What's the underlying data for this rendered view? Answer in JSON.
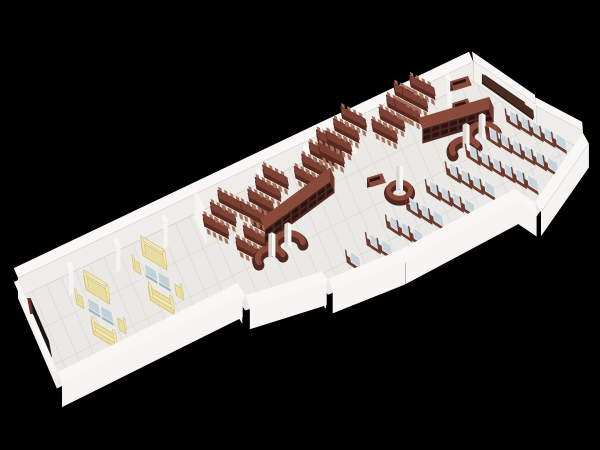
{
  "scene": {
    "description": "3D axonometric cutaway render of a long narrow library / reading room floor plan viewed from above on a black background",
    "background": "#000000",
    "zones": [
      {
        "name": "media-wall",
        "items": [
          {
            "type": "display-panel",
            "count": 1
          }
        ]
      },
      {
        "name": "lounge",
        "items": [
          {
            "type": "sofa",
            "count": 4
          },
          {
            "type": "armchair",
            "count": 4
          },
          {
            "type": "glass-coffee-table",
            "count": 4
          }
        ]
      },
      {
        "name": "reading-tables",
        "items": [
          {
            "type": "long-table-with-chairs",
            "count": 26
          }
        ]
      },
      {
        "name": "book-stacks",
        "items": [
          {
            "type": "double-sided-bookshelf",
            "count": 2
          },
          {
            "type": "small-shelf",
            "count": 3
          },
          {
            "type": "curved-service-desk",
            "count": 2
          },
          {
            "type": "round-kiosk-desk",
            "count": 1
          },
          {
            "type": "column",
            "count": 5
          }
        ]
      },
      {
        "name": "study-carrels",
        "items": [
          {
            "type": "carrel-desk-with-chair",
            "count": 46
          }
        ]
      },
      {
        "name": "presentation-wall",
        "items": [
          {
            "type": "green-board",
            "count": 1
          },
          {
            "type": "media-counter",
            "count": 1
          }
        ]
      }
    ],
    "palette": {
      "bg": "#000000",
      "wallTop": "#f8f7f5",
      "wallFace": "#efede9",
      "wallFaceAlt": "#f3f1ec",
      "wallOuter": "#f5f4f1",
      "floor": "#ebe9e5",
      "grid": "#dcd9d3",
      "woodDark": "#4f2620",
      "wood": "#6e382c",
      "woodTop": "#8a4a3a",
      "shelfSlot": "#2a1410",
      "tableTop": "#7c4134",
      "tableSide": "#57291f",
      "chairNub": "#a4705a",
      "glass": "#c7d3d9",
      "glassEdge": "#eef2f3",
      "deskBase": "#6b3a2d",
      "sofa": "#eadc9e",
      "sofaDark": "#cdbb7a",
      "sofaLight": "#f2e7b4",
      "coffeeGlass": "#c2d1d7",
      "coffeeEdge": "#9fb4bc",
      "board": "#2f5f4b",
      "boardInner": "#3c7259",
      "boardFrame": "#45291d",
      "counterDark": "#301d16",
      "counterTop": "#4a2c20",
      "tvBlack": "#121212",
      "tvFrame": "#6e2b1e",
      "column": "#f7f6f3",
      "columnSide": "#dbd8d3"
    },
    "layout": {
      "proj": {
        "U": [
          4.73,
          -2.35
        ],
        "V": [
          5.0,
          11.6
        ],
        "O": [
          18,
          298
        ]
      },
      "floor": [
        [
          0,
          0
        ],
        [
          95.5,
          0.7
        ],
        [
          103.2,
          6.0
        ],
        [
          109.5,
          9.4
        ],
        [
          96,
          12.6
        ],
        [
          93.5,
          10.9
        ],
        [
          69,
          11.2
        ],
        [
          54.2,
          10.7
        ],
        [
          53.8,
          9.9
        ],
        [
          38.6,
          8.9
        ],
        [
          38.2,
          7.8
        ],
        [
          0,
          7.8
        ]
      ],
      "backWalls": [
        {
          "a": [
            0,
            0
          ],
          "b": [
            95.5,
            0.7
          ],
          "h": 20,
          "out": [
            0,
            -1
          ],
          "face": "wallFace"
        },
        {
          "a": [
            95.5,
            0.7
          ],
          "b": [
            103.2,
            6.0
          ],
          "h": 21,
          "out": [
            0.57,
            -0.82
          ],
          "face": "wallFaceAlt"
        },
        {
          "a": [
            103.2,
            6.0
          ],
          "b": [
            109.5,
            9.4
          ],
          "h": 19,
          "out": [
            0.63,
            -0.77
          ],
          "face": "wallFace"
        },
        {
          "a": [
            0,
            7.8
          ],
          "b": [
            0,
            0
          ],
          "h": 18,
          "out": [
            -1,
            0
          ],
          "face": "wallFaceAlt"
        }
      ],
      "frontWalls": [
        {
          "a": [
            109.5,
            9.4
          ],
          "b": [
            96,
            12.6
          ],
          "h": 17
        },
        {
          "a": [
            96,
            12.6
          ],
          "b": [
            93.5,
            10.9
          ],
          "h": 16
        },
        {
          "a": [
            93.5,
            10.9
          ],
          "b": [
            69,
            11.2
          ],
          "h": 16
        },
        {
          "a": [
            69,
            11.2
          ],
          "b": [
            54.2,
            10.7
          ],
          "h": 16
        },
        {
          "a": [
            54.2,
            10.7
          ],
          "b": [
            53.8,
            9.9
          ],
          "h": 15
        },
        {
          "a": [
            53.8,
            9.9
          ],
          "b": [
            38.6,
            8.9
          ],
          "h": 15
        },
        {
          "a": [
            38.6,
            8.9
          ],
          "b": [
            38.2,
            7.8
          ],
          "h": 15
        },
        {
          "a": [
            38.2,
            7.8
          ],
          "b": [
            0,
            7.8
          ],
          "h": 16
        }
      ],
      "stub": {
        "a": [
          38,
          2.4
        ],
        "b": [
          38,
          0
        ],
        "h": 16
      },
      "pilasters": [
        10,
        20,
        30,
        50,
        60,
        70,
        80,
        90
      ],
      "tv": {
        "x": 1.0,
        "y1": 1.5,
        "y2": 5.2,
        "h": 15
      },
      "board": {
        "t1": 0.18,
        "t2": 0.82,
        "e1": 4,
        "e2": 15
      },
      "counter": {
        "a": [
          96.4,
          1.8
        ],
        "b": [
          102.6,
          6.2
        ],
        "h": 10
      },
      "sofaGroups": [
        [
          13,
          4.2
        ],
        [
          25.5,
          3.8
        ]
      ],
      "sofaRot": 31,
      "tableGroups": [
        [
          39.5,
          2.2,
          3
        ],
        [
          43.5,
          5.0,
          4
        ],
        [
          47.0,
          2.6,
          4
        ],
        [
          59.0,
          2.0,
          4
        ],
        [
          65.0,
          1.2,
          4
        ],
        [
          76.0,
          1.4,
          4
        ],
        [
          81.5,
          0.8,
          3
        ]
      ],
      "tableRot": 28,
      "shelves": [
        [
          47,
          4.9,
          63,
          3.7
        ],
        [
          82,
          3.3,
          96,
          4.3
        ]
      ],
      "smallShelves": [
        [
          92.5,
          1.1,
          3.5
        ],
        [
          91,
          2.7,
          3.0
        ],
        [
          70.5,
          5.0,
          3.0
        ]
      ],
      "sDesks": [
        [
          48.5,
          6.3
        ],
        [
          90.5,
          5.4
        ]
      ],
      "kiosk": [
        74,
        6.3
      ],
      "deskGrid": {
        "origin": [
          94.3,
          5.7
        ],
        "rowStep": [
          -4.8,
          0.55
        ],
        "unitStep": [
          1.58,
          0.82
        ],
        "rowsFrom": -2,
        "rowsTo": 8,
        "units": 8,
        "rot": 33
      }
    }
  }
}
